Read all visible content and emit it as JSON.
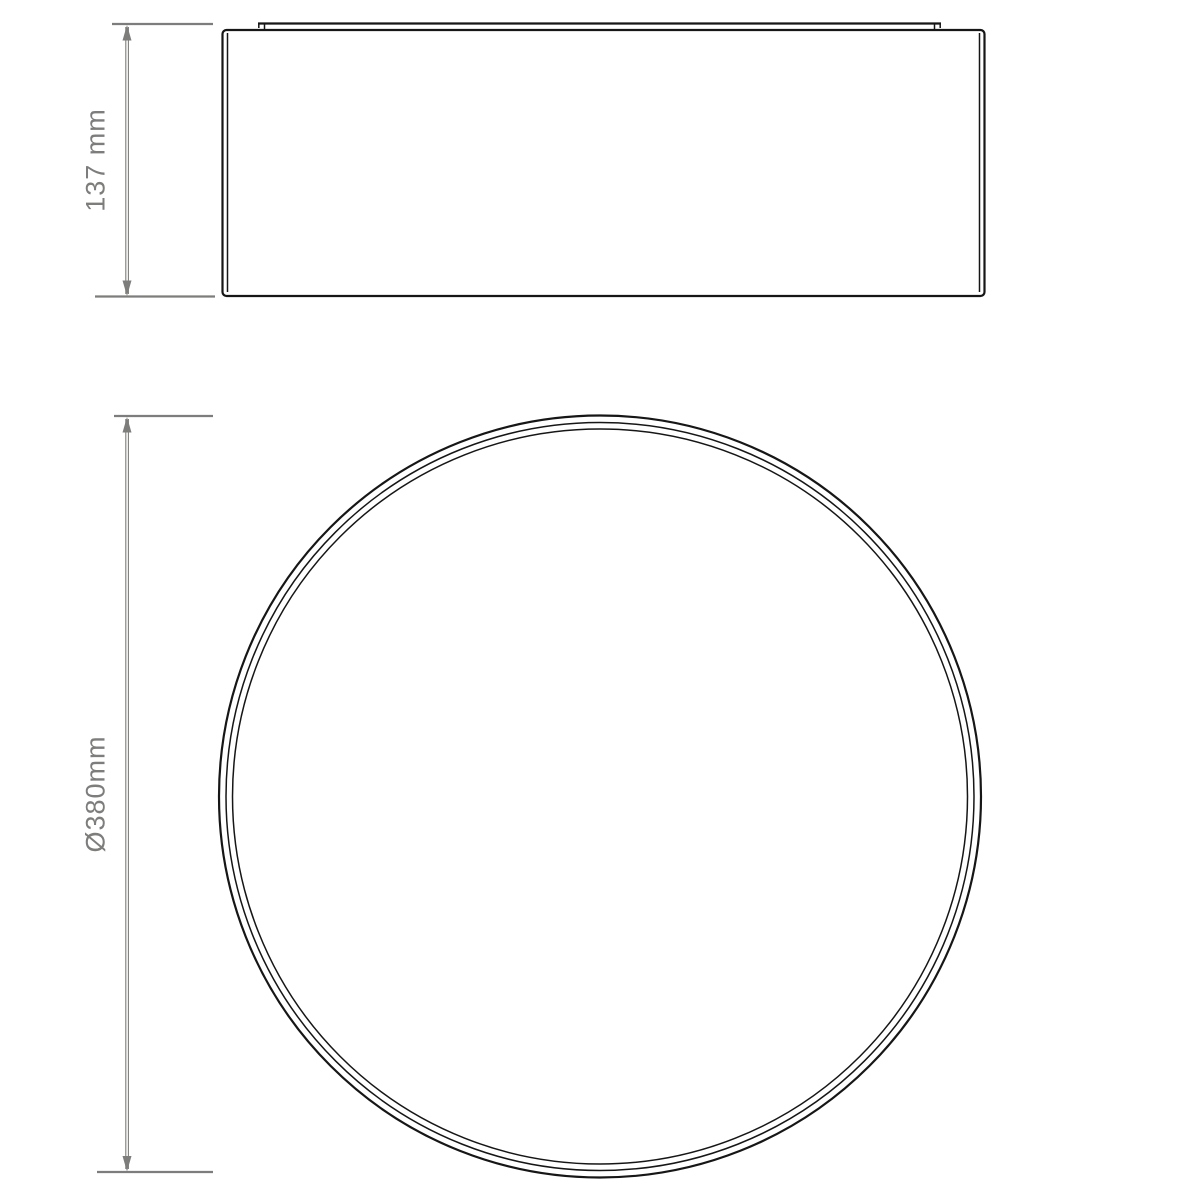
{
  "colors": {
    "background": "#ffffff",
    "drawing": "#161616",
    "dimension": "#7d7d7b"
  },
  "dimensions": {
    "height": {
      "label": "137 mm"
    },
    "diameter": {
      "label": "Ø380mm"
    }
  }
}
